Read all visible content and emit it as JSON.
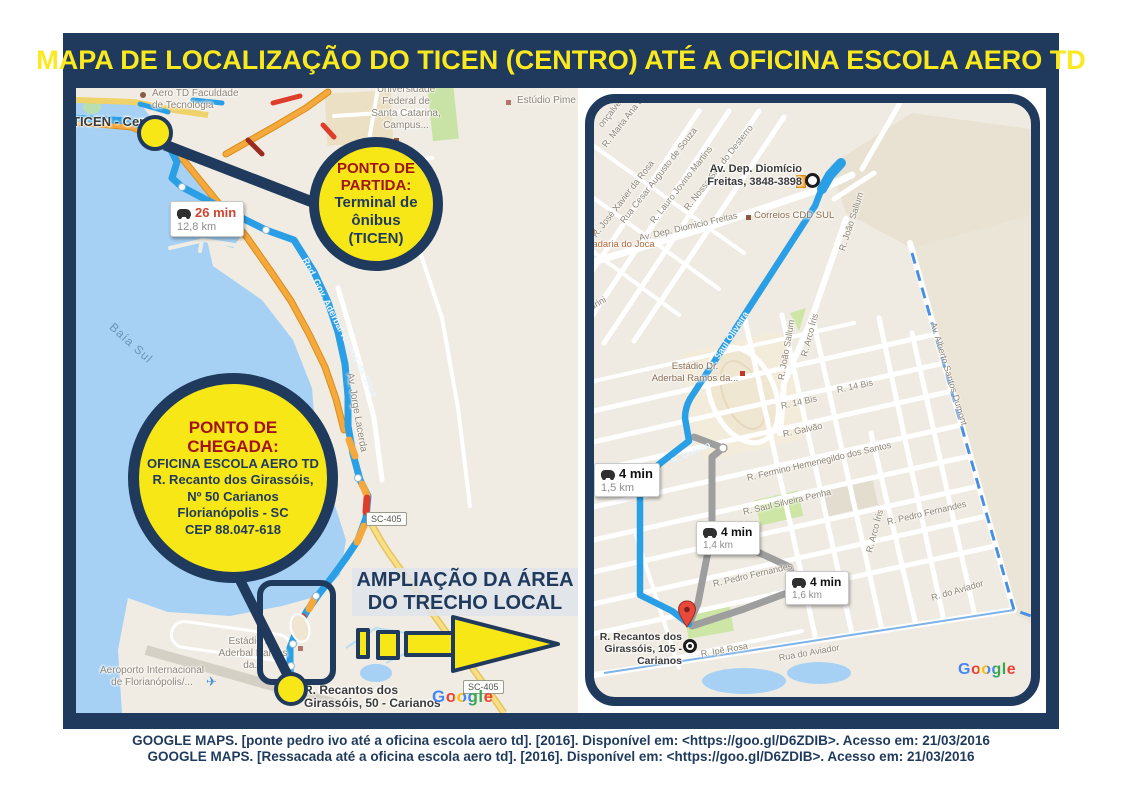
{
  "title": "MAPA DE LOCALIZAÇÃO DO TICEN (CENTRO) ATÉ A OFICINA ESCOLA AERO TD",
  "callouts": {
    "partida": {
      "heading": "PONTO DE\nPARTIDA:",
      "body": "Terminal de\nônibus\n(TICEN)"
    },
    "chegada": {
      "heading": "PONTO DE\nCHEGADA:",
      "body": "OFICINA ESCOLA AERO TD\nR. Recanto dos Girassóis,\nNº 50 Carianos\nFlorianópolis - SC\nCEP 88.047-618"
    }
  },
  "ampliacao_label": "AMPLIAÇÃO DA ÁREA\nDO TRECHO LOCAL",
  "overview_map": {
    "route_summary": {
      "duration": "26 min",
      "distance": "12,8 km"
    },
    "labels": {
      "ticen": "TICEN - Centro",
      "aero_td": "Aero TD Faculdade\nde Tecnologia",
      "ufsc": "Universidade\nFederal de\nSanta Catarina,\nCampus...",
      "estudio": "Estúdio Pime",
      "baia_sul": "Baía Sul",
      "rod_gov": "Rod. Gov. Aderbal Ramos da Silva",
      "av_jorge": "Av. Jorge Lacerda",
      "estadio": "Estádio Dr.\nAderbal Ramos da...",
      "aeroporto": "Aeroporto Internacional\nde Florianópolis/...",
      "recantos": "R. Recantos dos\nGirassóis, 50 - Carianos",
      "sc405": "SC-405"
    },
    "google": "Google"
  },
  "detail_map": {
    "start_label": "Av. Dep. Diomício\nFreitas, 3848-3898",
    "end_label": "R. Recantos dos\nGirassóis, 105 - Carianos",
    "route_options": [
      {
        "duration": "4 min",
        "distance": "1,5 km"
      },
      {
        "duration": "4 min",
        "distance": "1,4 km"
      },
      {
        "duration": "4 min",
        "distance": "1,6 km"
      }
    ],
    "streets": [
      "onçalves",
      "R. Maria Ana Bittencourt",
      "R. José Xavier da Rosa",
      "Rua Cesar Augusto de Souza",
      "R. Lauro Jovino Martins",
      "R. Nossa Sra. do Desterro",
      "Av. Dep. Diomicio Freitas",
      "R. João Sallum",
      "R. João Sallum",
      "R. Saul Oliveira",
      "drini",
      "R. Arco Íris",
      "R. Arco Íris",
      "R. 14 Bis",
      "R. 14 Bis",
      "R. Galvão",
      "R. Fermino Hemenegildo dos Santos",
      "R. Saul Silveira Penha",
      "R. Pedro Fernandes",
      "R. Pedro Fernandes",
      "R. do Aviador",
      "Rua do Aviador",
      "R. Ipê Rosa",
      "Av. Alberto Santos Dumont",
      "R. Galvão"
    ],
    "pois": {
      "correios": "Correios CDD SUL",
      "padaria": "Padaria do Joca",
      "estadio": "Estádio Dr.\nAderbal Ramos da..."
    },
    "google": "Google"
  },
  "citations": [
    "GOOGLE MAPS. [ponte pedro ivo até a oficina escola aero td]. [2016]. Disponível em: <https://goo.gl/D6ZDIB>. Acesso em: 21/03/2016",
    "GOOGLE MAPS. [Ressacada até a oficina escola aero td]. [2016]. Disponível em: <https://goo.gl/D6ZDIB>. Acesso em: 21/03/2016"
  ],
  "colors": {
    "frame_navy": "#1f3a5c",
    "title_yellow": "#fbe920",
    "callout_yellow": "#f7e717",
    "heading_red": "#a21318",
    "route_blue": "#2b9fe5",
    "alt_route_gray": "#9e9e9e",
    "water": "#a6d1f4",
    "land": "#f0ece3",
    "road_orange": "#f5a83b",
    "traffic_red": "#dd3e2b"
  }
}
